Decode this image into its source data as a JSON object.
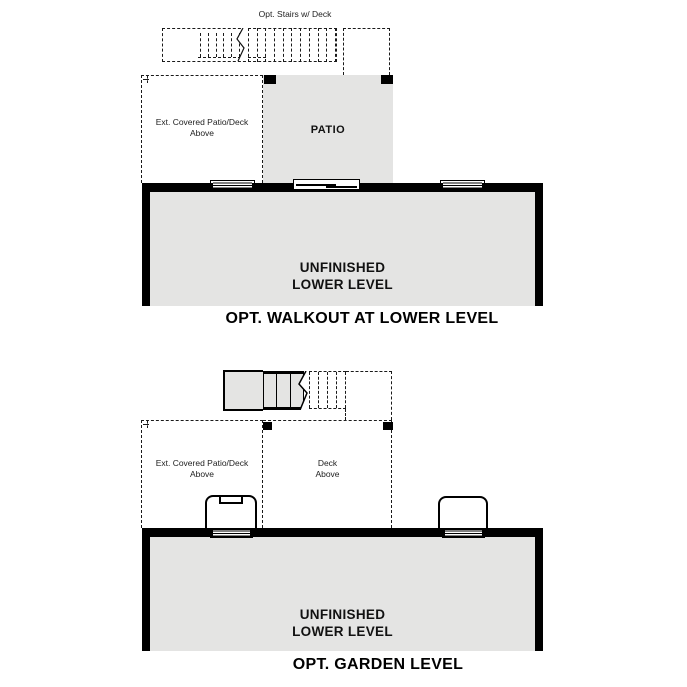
{
  "colors": {
    "floor_fill": "#e4e4e3",
    "wall": "#000000",
    "line": "#1a1a1a",
    "background": "#ffffff"
  },
  "walkout_plan": {
    "stairs_label": "Opt. Stairs w/ Deck",
    "ext_patio_label": "Ext. Covered Patio/Deck\nAbove",
    "patio_label": "PATIO",
    "room_label": "UNFINISHED\nLOWER LEVEL",
    "caption": "OPT. WALKOUT AT LOWER LEVEL"
  },
  "garden_plan": {
    "ext_patio_label": "Ext. Covered Patio/Deck\nAbove",
    "deck_label": "Deck\nAbove",
    "room_label": "UNFINISHED\nLOWER LEVEL",
    "caption": "OPT. GARDEN LEVEL"
  }
}
